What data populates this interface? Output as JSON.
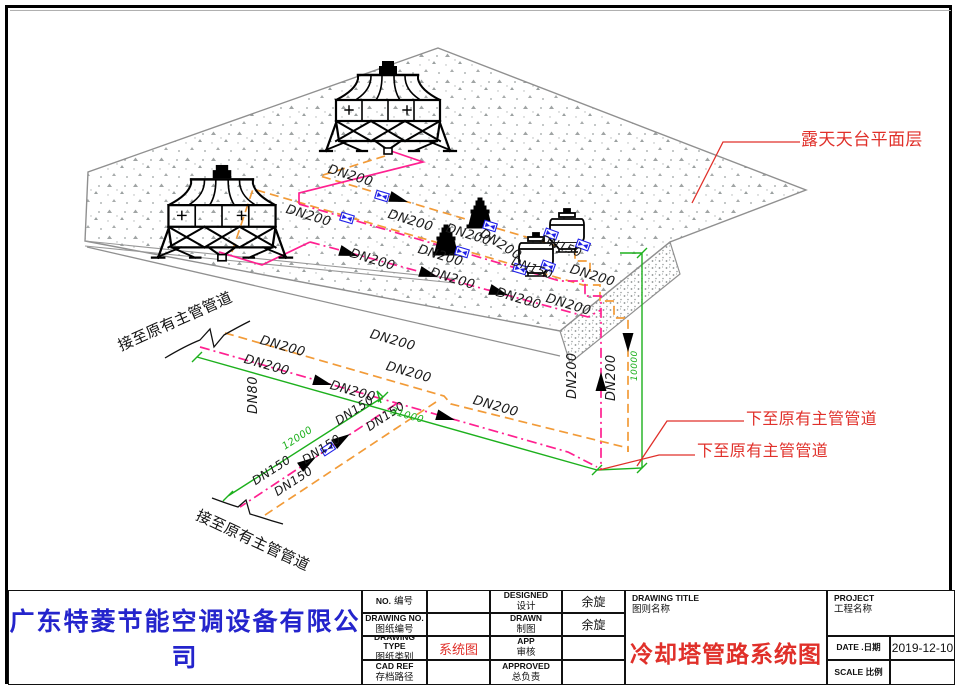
{
  "title_block": {
    "company": "广东特菱节能空调设备有限公司",
    "no": {
      "en": "NO.",
      "zh": "编号",
      "value": ""
    },
    "drawing_no": {
      "en": "DRAWING NO.",
      "zh": "图纸编号",
      "value": ""
    },
    "drawing_type": {
      "en": "DRAWING TYPE",
      "zh": "图纸类别",
      "value": "系统图"
    },
    "cad_ref": {
      "en": "CAD REF",
      "zh": "存档路径",
      "value": ""
    },
    "designed": {
      "en": "DESIGNED",
      "zh": "设计",
      "value": "余旋"
    },
    "drawn": {
      "en": "DRAWN",
      "zh": "制图",
      "value": "余旋"
    },
    "app": {
      "en": "APP",
      "zh": "审核",
      "value": ""
    },
    "approved": {
      "en": "APPROVED",
      "zh": "总负责",
      "value": ""
    },
    "drawing_title": {
      "en": "DRAWING TITLE",
      "zh": "图则名称",
      "value": "冷却塔管路系统图"
    },
    "project": {
      "en": "PROJECT",
      "zh": "工程名称",
      "value": ""
    },
    "date": {
      "en": "DATE .日期",
      "value": "2019-12-10"
    },
    "scale": {
      "en": "SCALE 比例",
      "value": ""
    }
  },
  "drawing": {
    "colors": {
      "pipe_orange": "#f29b38",
      "pipe_magenta": "#ff2090",
      "dim_green": "#1db01d",
      "annotation_red": "#e0302a",
      "valve_blue": "#2020e8"
    },
    "labels": [
      {
        "t": "DN200",
        "x": 330,
        "y": 163,
        "r": 17,
        "c": "#1a1a1a",
        "s": 13,
        "i": 1
      },
      {
        "t": "DN200",
        "x": 288,
        "y": 203,
        "r": 17,
        "c": "#1a1a1a",
        "s": 13,
        "i": 1
      },
      {
        "t": "DN200",
        "x": 390,
        "y": 208,
        "r": 17,
        "c": "#1a1a1a",
        "s": 13,
        "i": 1
      },
      {
        "t": "DN200",
        "x": 448,
        "y": 222,
        "r": 17,
        "c": "#1a1a1a",
        "s": 13,
        "i": 1
      },
      {
        "t": "DN200",
        "x": 484,
        "y": 227,
        "r": 32,
        "c": "#1a1a1a",
        "s": 13,
        "i": 1
      },
      {
        "t": "DN200",
        "x": 420,
        "y": 243,
        "r": 17,
        "c": "#1a1a1a",
        "s": 13,
        "i": 1
      },
      {
        "t": "DN200",
        "x": 352,
        "y": 247,
        "r": 17,
        "c": "#1a1a1a",
        "s": 13,
        "i": 1
      },
      {
        "t": "DN200",
        "x": 432,
        "y": 266,
        "r": 17,
        "c": "#1a1a1a",
        "s": 13,
        "i": 1
      },
      {
        "t": "DN200",
        "x": 498,
        "y": 286,
        "r": 17,
        "c": "#1a1a1a",
        "s": 13,
        "i": 1
      },
      {
        "t": "DN200",
        "x": 548,
        "y": 292,
        "r": 17,
        "c": "#1a1a1a",
        "s": 13,
        "i": 1
      },
      {
        "t": "DN200",
        "x": 572,
        "y": 263,
        "r": 17,
        "c": "#1a1a1a",
        "s": 13,
        "i": 1
      },
      {
        "t": "DN200",
        "x": 372,
        "y": 328,
        "r": 16,
        "c": "#1a1a1a",
        "s": 13,
        "i": 1
      },
      {
        "t": "DN200",
        "x": 388,
        "y": 360,
        "r": 16,
        "c": "#1a1a1a",
        "s": 13,
        "i": 1
      },
      {
        "t": "DN200",
        "x": 475,
        "y": 394,
        "r": 16,
        "c": "#1a1a1a",
        "s": 13,
        "i": 1
      },
      {
        "t": "DN200",
        "x": 332,
        "y": 379,
        "r": 16,
        "c": "#1a1a1a",
        "s": 13,
        "i": 1
      },
      {
        "t": "DN200",
        "x": 262,
        "y": 334,
        "r": 16,
        "c": "#1a1a1a",
        "s": 13,
        "i": 1
      },
      {
        "t": "DN200",
        "x": 246,
        "y": 353,
        "r": 16,
        "c": "#1a1a1a",
        "s": 13,
        "i": 1
      },
      {
        "t": "DN200",
        "x": 566,
        "y": 399,
        "r": -90,
        "c": "#1a1a1a",
        "s": 13,
        "i": 1
      },
      {
        "t": "DN200",
        "x": 605,
        "y": 401,
        "r": -90,
        "c": "#1a1a1a",
        "s": 13,
        "i": 1
      },
      {
        "t": "DN150",
        "x": 543,
        "y": 233,
        "r": 20,
        "c": "#1a1a1a",
        "s": 12,
        "i": 1
      },
      {
        "t": "DN150",
        "x": 514,
        "y": 255,
        "r": 20,
        "c": "#1a1a1a",
        "s": 12,
        "i": 1
      },
      {
        "t": "DN150",
        "x": 333,
        "y": 417,
        "r": -33,
        "c": "#1a1a1a",
        "s": 12,
        "i": 1
      },
      {
        "t": "DN150",
        "x": 364,
        "y": 423,
        "r": -33,
        "c": "#1a1a1a",
        "s": 12,
        "i": 1
      },
      {
        "t": "DN150",
        "x": 300,
        "y": 456,
        "r": -33,
        "c": "#1a1a1a",
        "s": 12,
        "i": 1
      },
      {
        "t": "DN150",
        "x": 250,
        "y": 477,
        "r": -33,
        "c": "#1a1a1a",
        "s": 12,
        "i": 1
      },
      {
        "t": "DN150",
        "x": 272,
        "y": 488,
        "r": -33,
        "c": "#1a1a1a",
        "s": 12,
        "i": 1
      },
      {
        "t": "DN80",
        "x": 247,
        "y": 414,
        "r": -90,
        "c": "#1a1a1a",
        "s": 13,
        "i": 1
      },
      {
        "t": "31000",
        "x": 392,
        "y": 407,
        "r": 16,
        "c": "#1db01d",
        "s": 10,
        "i": 1,
        "n": "dimension-label"
      },
      {
        "t": "12000",
        "x": 281,
        "y": 444,
        "r": -33,
        "c": "#1db01d",
        "s": 10,
        "i": 1,
        "n": "dimension-label"
      },
      {
        "t": "10000",
        "x": 631,
        "y": 381,
        "r": -90,
        "c": "#1db01d",
        "s": 9,
        "i": 1,
        "n": "dimension-label"
      },
      {
        "t": "露天天台平面层",
        "x": 801,
        "y": 132,
        "r": 0,
        "c": "#e0302a",
        "s": 17,
        "n": "annotation-rooftop-level"
      },
      {
        "t": "下至原有主管管道",
        "x": 746,
        "y": 411,
        "r": 0,
        "c": "#e0302a",
        "s": 16,
        "n": "annotation-down-to-main-1"
      },
      {
        "t": "下至原有主管管道",
        "x": 697,
        "y": 443,
        "r": 0,
        "c": "#e0302a",
        "s": 16,
        "n": "annotation-down-to-main-2"
      },
      {
        "t": "接至原有主管管道",
        "x": 116,
        "y": 340,
        "r": -24,
        "c": "#111111",
        "s": 15,
        "n": "annotation-connect-to-main-1"
      },
      {
        "t": "接至原有主管管道",
        "x": 200,
        "y": 508,
        "r": 25,
        "c": "#111111",
        "s": 15,
        "n": "annotation-connect-to-main-2"
      }
    ]
  }
}
